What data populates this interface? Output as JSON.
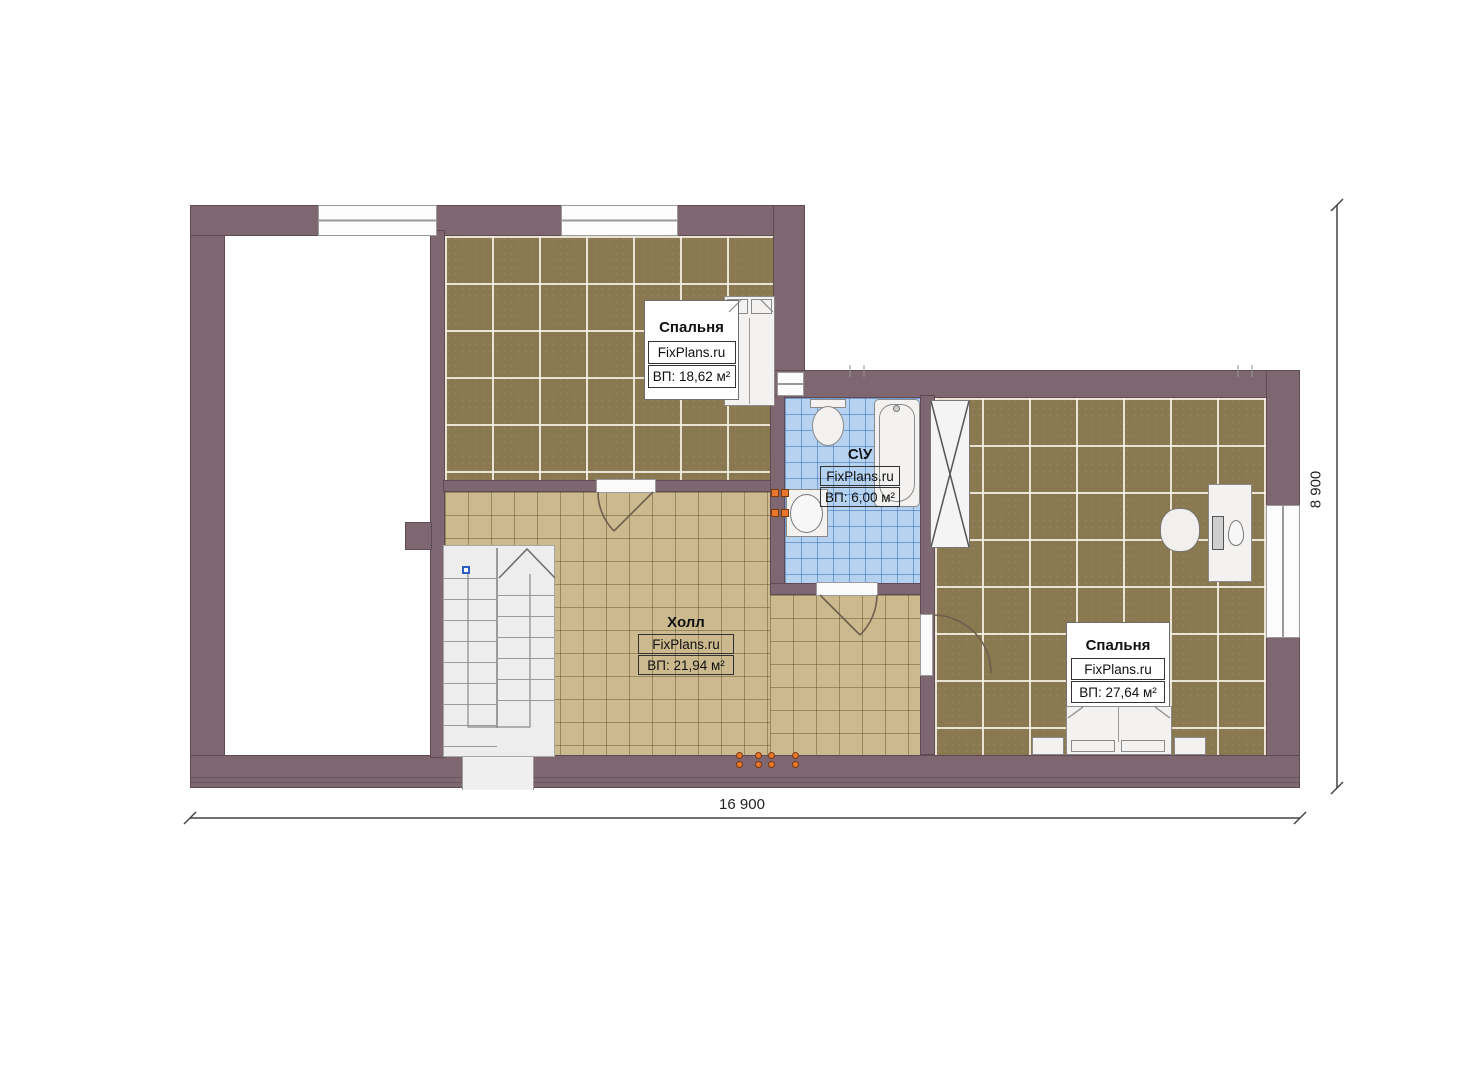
{
  "plan": {
    "name": "second-floor-plan",
    "rooms": [
      {
        "id": "bedroom-1",
        "title": "Спальня",
        "watermark": "FixPlans.ru",
        "area_label": "ВП: 18,62 м²"
      },
      {
        "id": "bathroom",
        "title": "С\\У",
        "watermark": "FixPlans.ru",
        "area_label": "ВП: 6,00 м²"
      },
      {
        "id": "hall",
        "title": "Холл",
        "watermark": "FixPlans.ru",
        "area_label": "ВП: 21,94 м²"
      },
      {
        "id": "bedroom-2",
        "title": "Спальня",
        "watermark": "FixPlans.ru",
        "area_label": "ВП: 27,64 м²"
      }
    ],
    "dimensions": {
      "overall_width": "16 900",
      "overall_height": "8 900"
    },
    "colors": {
      "wall": "#7e6770",
      "bedroom_tile": "#8a7850",
      "hall_tile": "#ccb98e",
      "bathroom_tile": "#b5d3f0",
      "stair": "#ededed",
      "fixture_outline": "#8a8a8a",
      "outlet_orange": "#e8762c",
      "marker_blue": "#2f5fc4"
    }
  }
}
